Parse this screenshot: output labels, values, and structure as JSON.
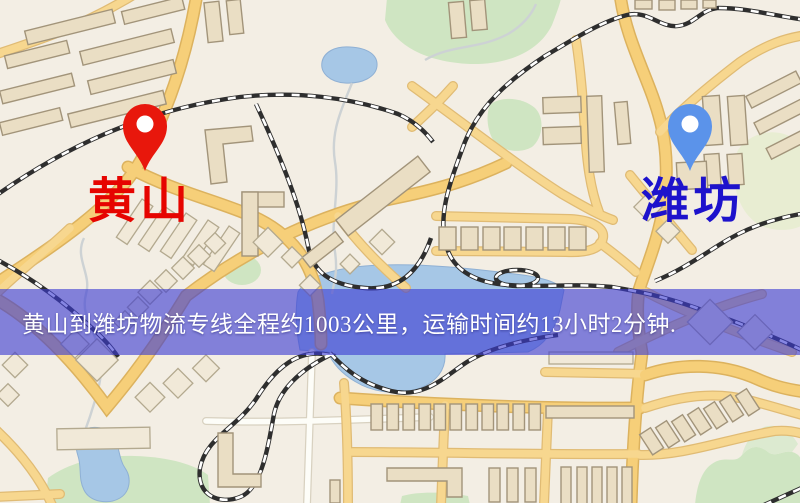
{
  "banner": {
    "text": "黄山到潍坊物流专线全程约1003公里，运输时间约13小时2分钟.",
    "bg_color": "rgba(60,60,210,0.62)",
    "text_color": "#ffffff"
  },
  "markers": [
    {
      "id": "origin",
      "label": "黄山",
      "pin_color": "#e8170c",
      "label_color": "#e60400"
    },
    {
      "id": "destination",
      "label": "潍坊",
      "pin_color": "#5b93ea",
      "label_color": "#1d12cc"
    }
  ],
  "route": {
    "distance_km": "1003",
    "duration": "13小时2分钟"
  },
  "map_colors": {
    "background": "#f3eee4",
    "road_yellow": "#f6cf79",
    "water_blue": "#a6c7e6",
    "park_green": "#cfe5c2",
    "building_tan": "#eadec4",
    "railway_dark": "#2e2e2e"
  }
}
